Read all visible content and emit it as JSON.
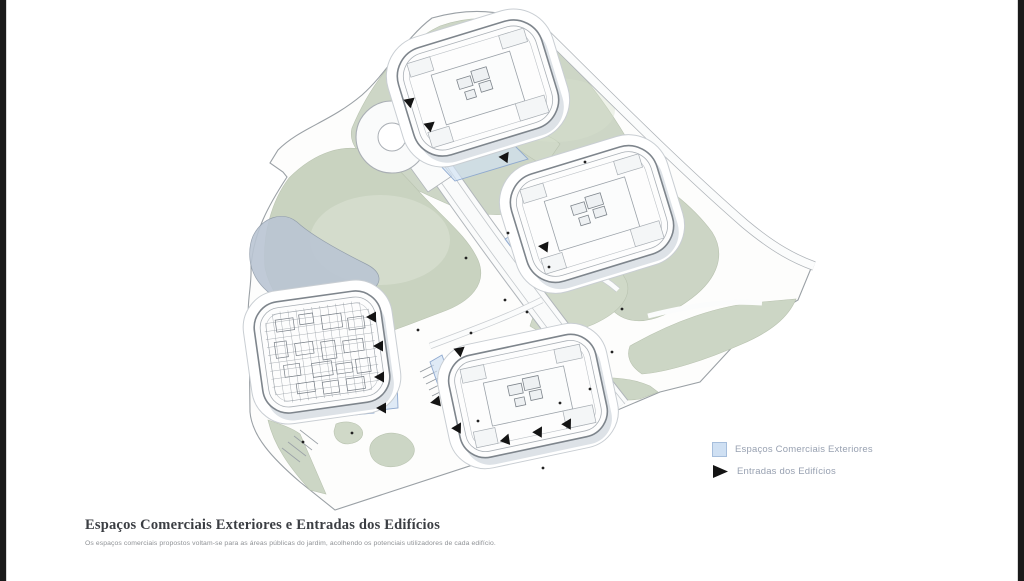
{
  "window": {
    "background": "#ffffff",
    "left_bar_color": "#1a1a1a",
    "right_bar_color": "#1a1a1a"
  },
  "caption": {
    "title": "Espaços Comerciais Exteriores e Entradas dos Edifícios",
    "subtitle": "Os espaços comerciais propostos voltam-se para as áreas públicas do jardim, acolhendo os potenciais utilizadores de cada edifício."
  },
  "legend": {
    "items": [
      {
        "id": "commercial-spaces",
        "label": "Espaços Comerciais Exteriores",
        "swatch": "blue-square",
        "fill": "#cfe0f3",
        "stroke": "#a6bedc"
      },
      {
        "id": "building-entrances",
        "label": "Entradas dos Edifícios",
        "swatch": "black-triangle",
        "fill": "#141414"
      }
    ]
  },
  "map": {
    "colors": {
      "green": "#cdd6c6",
      "green_light": "#dde4d4",
      "pond": "#bac5d3",
      "ground": "#fdfdfc",
      "road_casing": "#aeb3b8",
      "building_stroke": "#7e858c",
      "commercial_fill": "#cfe0f3",
      "commercial_stroke": "#8fa9cf",
      "arrow": "#141414"
    },
    "buildings": [
      {
        "id": "building-1",
        "cx": 478,
        "cy": 88,
        "w": 150,
        "h": 112,
        "r": 30,
        "rot": -17,
        "style": "plan"
      },
      {
        "id": "building-2",
        "cx": 592,
        "cy": 214,
        "w": 152,
        "h": 112,
        "r": 30,
        "rot": -17,
        "style": "plan"
      },
      {
        "id": "building-3",
        "cx": 322,
        "cy": 352,
        "w": 128,
        "h": 112,
        "r": 26,
        "rot": -8,
        "style": "dense"
      },
      {
        "id": "building-4",
        "cx": 528,
        "cy": 396,
        "w": 150,
        "h": 104,
        "r": 26,
        "rot": -12,
        "style": "plan"
      }
    ],
    "commercial_areas": [
      {
        "points": "435,160 508,139 528,159 455,181"
      },
      {
        "points": "358,303 388,300 386,337 356,336"
      },
      {
        "points": "370,357 396,353 398,408 372,411"
      },
      {
        "points": "332,398 372,395 374,413 334,417"
      },
      {
        "points": "430,362 442,355 466,424 454,431"
      },
      {
        "points": "456,424 576,440 574,450 454,434"
      },
      {
        "points": "505,239 521,230 533,246 517,255"
      }
    ],
    "entrances": [
      {
        "x": 407,
        "y": 104,
        "angle": -40
      },
      {
        "x": 427,
        "y": 128,
        "angle": -40
      },
      {
        "x": 503,
        "y": 160,
        "angle": -55
      },
      {
        "x": 548,
        "y": 247,
        "angle": 185
      },
      {
        "x": 376,
        "y": 317,
        "angle": 180
      },
      {
        "x": 383,
        "y": 346,
        "angle": 180
      },
      {
        "x": 384,
        "y": 377,
        "angle": 180
      },
      {
        "x": 386,
        "y": 408,
        "angle": 180
      },
      {
        "x": 457,
        "y": 353,
        "angle": -40
      },
      {
        "x": 440,
        "y": 401,
        "angle": 170
      },
      {
        "x": 456,
        "y": 431,
        "angle": -60
      },
      {
        "x": 505,
        "y": 443,
        "angle": -70
      },
      {
        "x": 537,
        "y": 435,
        "angle": -60
      },
      {
        "x": 566,
        "y": 427,
        "angle": -60
      }
    ],
    "people": [
      {
        "x": 466,
        "y": 258
      },
      {
        "x": 505,
        "y": 300
      },
      {
        "x": 527,
        "y": 312
      },
      {
        "x": 549,
        "y": 267
      },
      {
        "x": 471,
        "y": 333
      },
      {
        "x": 612,
        "y": 352
      },
      {
        "x": 560,
        "y": 403
      },
      {
        "x": 590,
        "y": 389
      },
      {
        "x": 303,
        "y": 442
      },
      {
        "x": 352,
        "y": 433
      },
      {
        "x": 508,
        "y": 233
      },
      {
        "x": 622,
        "y": 309
      },
      {
        "x": 478,
        "y": 421
      },
      {
        "x": 543,
        "y": 468
      },
      {
        "x": 418,
        "y": 330
      },
      {
        "x": 585,
        "y": 162
      }
    ]
  }
}
